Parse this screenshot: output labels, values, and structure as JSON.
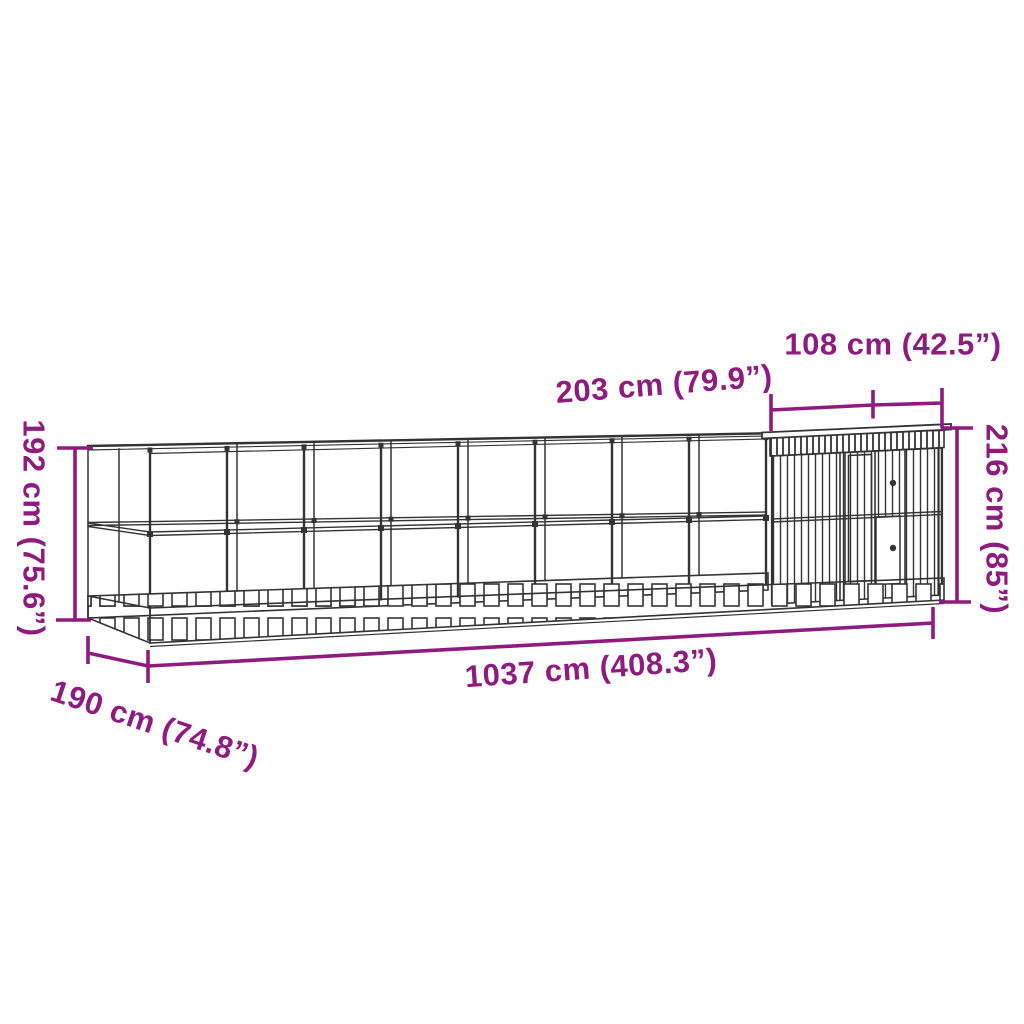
{
  "colors": {
    "accent": "#8E1C7F",
    "drawing": "#333333",
    "background": "#FFFFFF"
  },
  "figure": {
    "description": "Technical line drawing of a long walk-in aviary (bird cage run) with an attached house extension, drawn in perspective with purple dimension lines",
    "units": "cm (inches)"
  },
  "dimensions": {
    "height_left": "192 cm (75.6”)",
    "depth": "190 cm (74.8”)",
    "length_total": "1037 cm (408.3”)",
    "segment_top": "203 cm (79.9”)",
    "house_width": "108 cm (42.5”)",
    "height_right": "216 cm (85”)"
  }
}
